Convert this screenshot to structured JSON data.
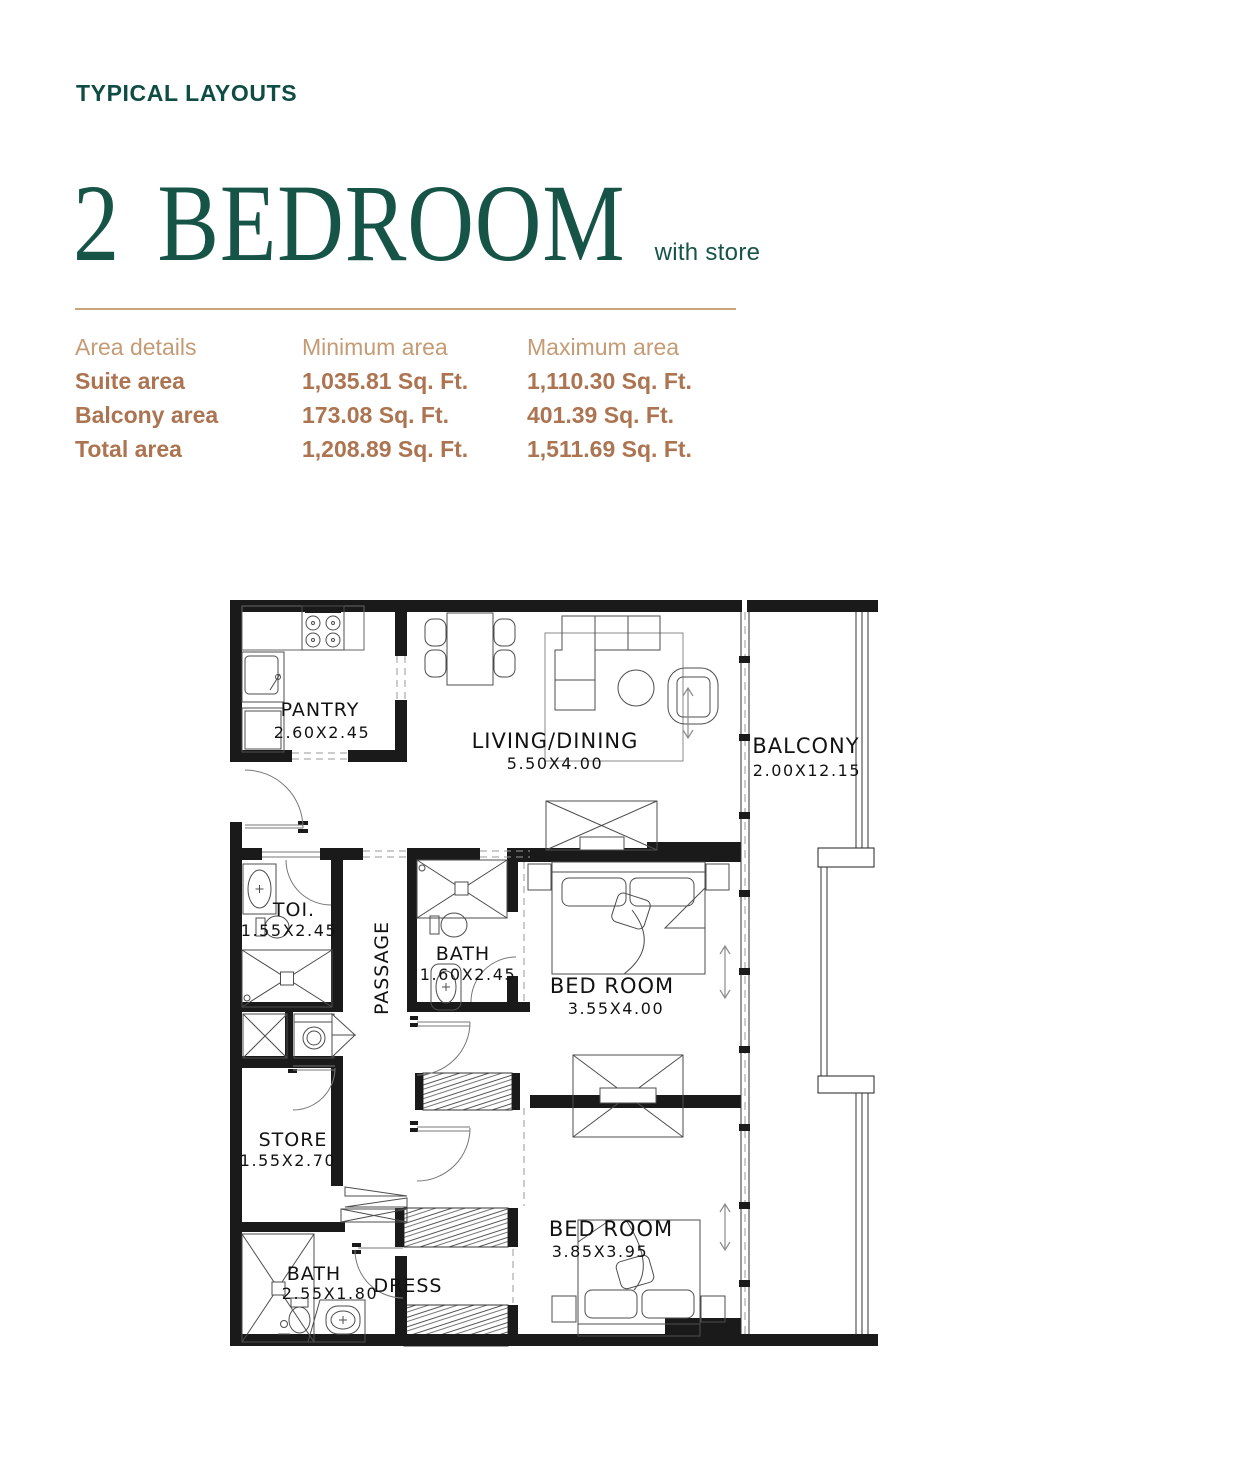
{
  "colors": {
    "teal": "#175448",
    "eyebrow_teal": "#0f4c44",
    "table_header_tan": "#c49b74",
    "table_value_brown": "#ac7450",
    "divider_tan": "#c8a57c",
    "wall_black": "#1a1a1a"
  },
  "header": {
    "eyebrow": "TYPICAL LAYOUTS",
    "title": "2 BEDROOM",
    "subtitle": "with store"
  },
  "area_table": {
    "columns": [
      "Area details",
      "Minimum area",
      "Maximum area"
    ],
    "rows": [
      {
        "label": "Suite area",
        "min": "1,035.81 Sq. Ft.",
        "max": "1,110.30 Sq. Ft."
      },
      {
        "label": "Balcony area",
        "min": "173.08 Sq. Ft.",
        "max": "401.39 Sq. Ft."
      },
      {
        "label": "Total area",
        "min": "1,208.89 Sq. Ft.",
        "max": "1,511.69 Sq. Ft."
      }
    ]
  },
  "floorplan": {
    "rooms": [
      {
        "name": "PANTRY",
        "dims": "2.60X2.45"
      },
      {
        "name": "LIVING/DINING",
        "dims": "5.50X4.00"
      },
      {
        "name": "BALCONY",
        "dims": "2.00X12.15"
      },
      {
        "name": "TOI.",
        "dims": "1.55X2.45"
      },
      {
        "name": "BATH",
        "dims": "1.60X2.45"
      },
      {
        "name": "BED ROOM",
        "dims": "3.55X4.00"
      },
      {
        "name": "PASSAGE",
        "dims": ""
      },
      {
        "name": "STORE",
        "dims": "1.55X2.70"
      },
      {
        "name": "BATH",
        "dims": "2.55X1.80"
      },
      {
        "name": "DRESS",
        "dims": ""
      },
      {
        "name": "BED ROOM",
        "dims": "3.85X3.95"
      }
    ]
  }
}
